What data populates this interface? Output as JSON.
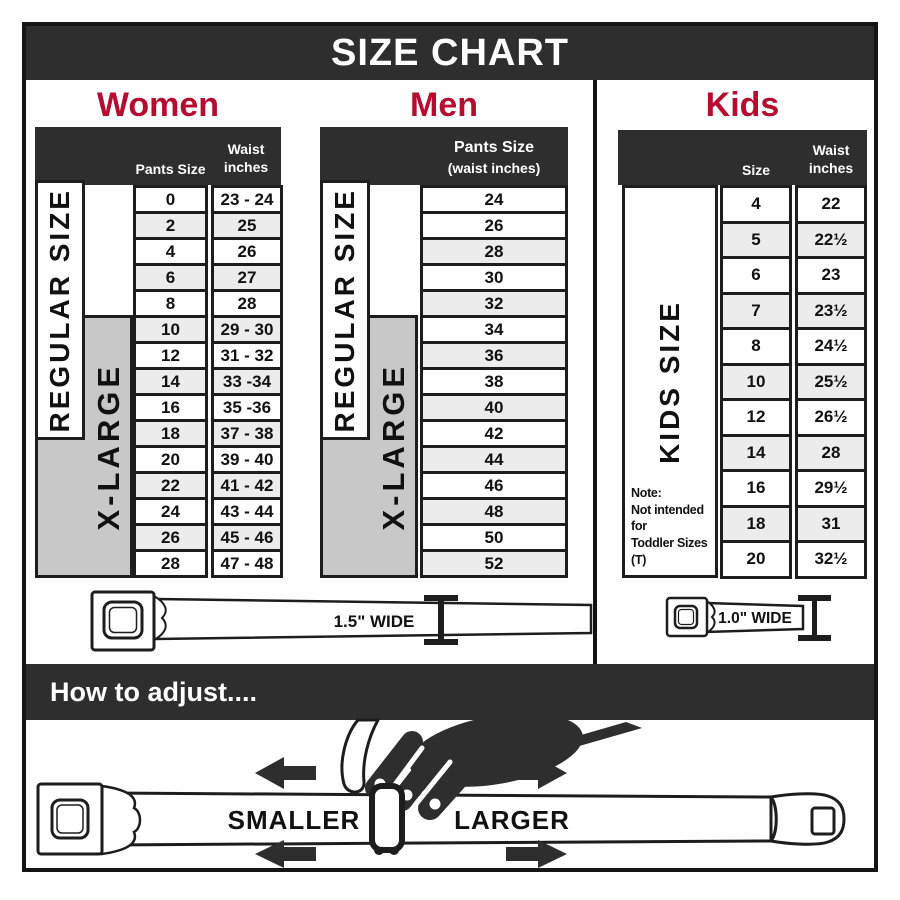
{
  "title": "SIZE CHART",
  "women": {
    "heading": "Women",
    "col1_header": "Pants Size",
    "col2_header": [
      "Waist",
      "inches"
    ],
    "regular_label": "REGULAR SIZE",
    "xlarge_label": "X-LARGE",
    "rows": [
      [
        "0",
        "23 - 24"
      ],
      [
        "2",
        "25"
      ],
      [
        "4",
        "26"
      ],
      [
        "6",
        "27"
      ],
      [
        "8",
        "28"
      ],
      [
        "10",
        "29 - 30"
      ],
      [
        "12",
        "31 - 32"
      ],
      [
        "14",
        "33 -34"
      ],
      [
        "16",
        "35 -36"
      ],
      [
        "18",
        "37 - 38"
      ],
      [
        "20",
        "39 - 40"
      ],
      [
        "22",
        "41 - 42"
      ],
      [
        "24",
        "43 - 44"
      ],
      [
        "26",
        "45 - 46"
      ],
      [
        "28",
        "47 - 48"
      ]
    ],
    "belt_label": "1.5\" WIDE"
  },
  "men": {
    "heading": "Men",
    "header": [
      "Pants Size",
      "(waist inches)"
    ],
    "regular_label": "REGULAR SIZE",
    "xlarge_label": "X-LARGE",
    "rows": [
      "24",
      "26",
      "28",
      "30",
      "32",
      "34",
      "36",
      "38",
      "40",
      "42",
      "44",
      "46",
      "48",
      "50",
      "52"
    ]
  },
  "kids": {
    "heading": "Kids",
    "col1_header": "Size",
    "col2_header": [
      "Waist",
      "inches"
    ],
    "side_label": "KIDS SIZE",
    "note": [
      "Note:",
      "Not intended for",
      "Toddler Sizes (T)"
    ],
    "rows": [
      [
        "4",
        "22"
      ],
      [
        "5",
        "22½"
      ],
      [
        "6",
        "23"
      ],
      [
        "7",
        "23½"
      ],
      [
        "8",
        "24½"
      ],
      [
        "10",
        "25½"
      ],
      [
        "12",
        "26½"
      ],
      [
        "14",
        "28"
      ],
      [
        "16",
        "29½"
      ],
      [
        "18",
        "31"
      ],
      [
        "20",
        "32½"
      ]
    ],
    "belt_label": "1.0\" WIDE"
  },
  "how_to": {
    "heading": "How to adjust....",
    "smaller": "SMALLER",
    "larger": "LARGER"
  },
  "colors": {
    "header_bar": "#2e2e2e",
    "accent_red": "#b60c2f",
    "row_alt": "#ececec",
    "xlarge_gray": "#c8c8c8",
    "line_black": "#1d1d1d"
  }
}
